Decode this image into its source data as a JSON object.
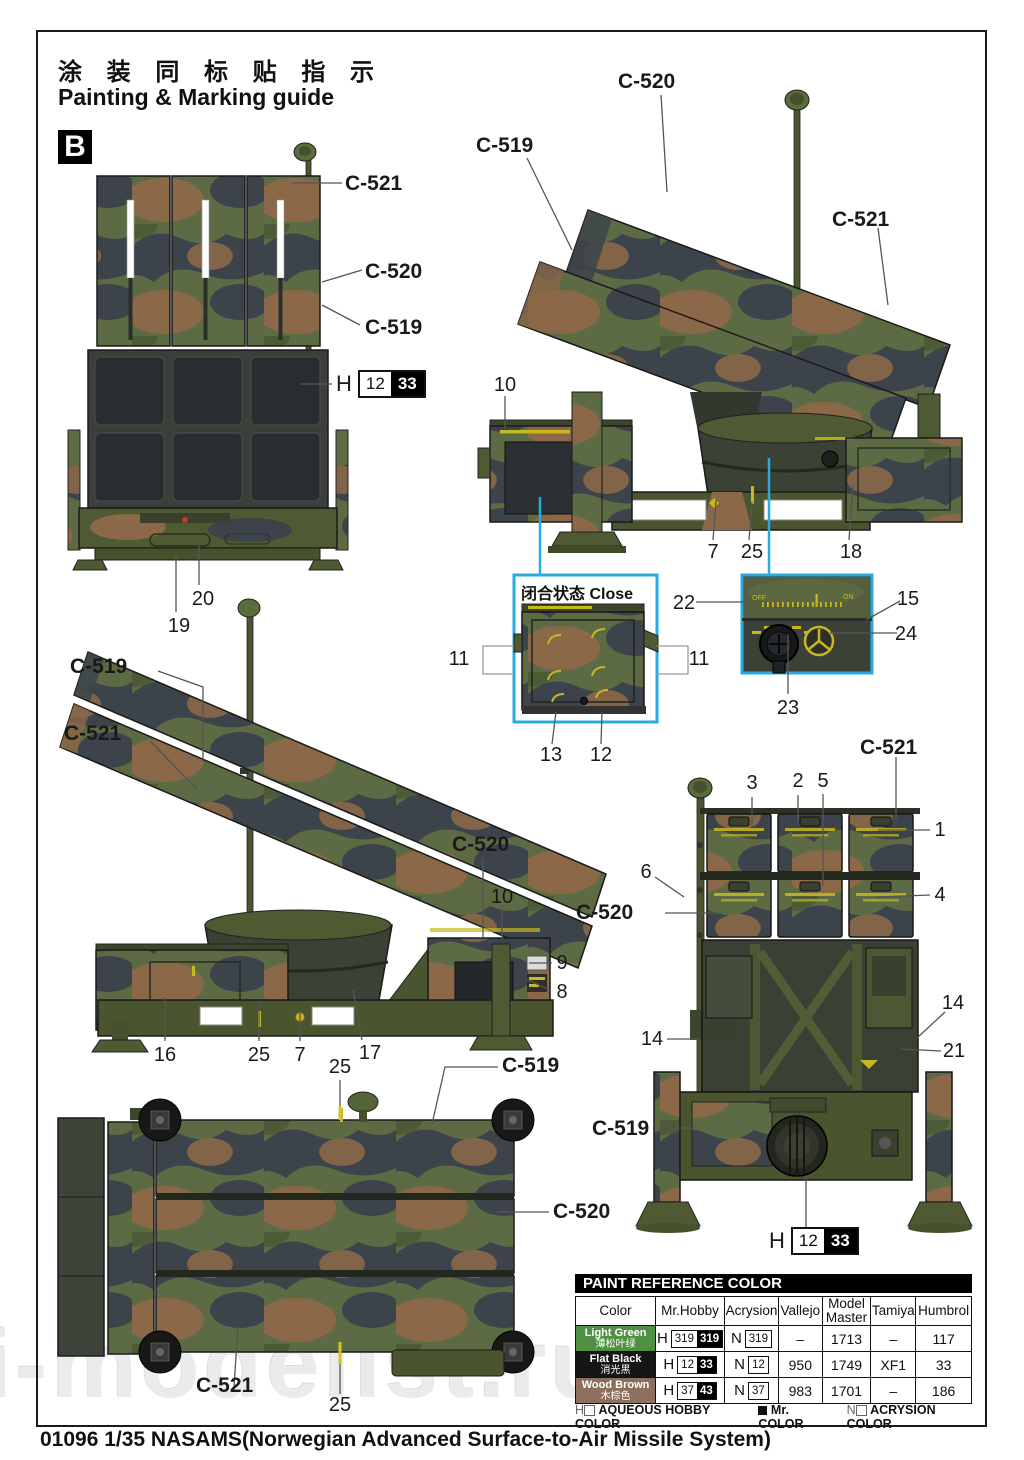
{
  "header": {
    "title_cn": "涂 装 同 标 贴 指 示",
    "title_en": "Painting & Marking guide",
    "section_letter": "B"
  },
  "watermark": "i-modelist.ru",
  "colors": {
    "accent_cyan": "#29abe2",
    "marking_yellow": "#c8b820",
    "camo_green": "#5c6b44",
    "camo_dark": "#3d434a",
    "camo_brown": "#8a6848"
  },
  "h_chip": {
    "prefix": "H",
    "white": "12",
    "black": "33"
  },
  "inset_close": {
    "title": "闭合状态 Close"
  },
  "inset_detail": {
    "off": "OFF",
    "on": "ON"
  },
  "callouts": {
    "c521_a": "C-521",
    "c520_a": "C-520",
    "c519_a": "C-519",
    "n20": "20",
    "n19": "19",
    "c520_b": "C-520",
    "c519_b": "C-519",
    "c521_b": "C-521",
    "n10_a": "10",
    "n7_a": "7",
    "n25_a": "25",
    "n18_a": "18",
    "n11_l": "11",
    "n11_r": "11",
    "n13": "13",
    "n12": "12",
    "n22": "22",
    "n15": "15",
    "n24": "24",
    "n23": "23",
    "c519_c": "C-519",
    "c521_c": "C-521",
    "c520_c": "C-520",
    "n10_b": "10",
    "n9": "9",
    "n8": "8",
    "n16": "16",
    "n25_b": "25",
    "n7_b": "7",
    "n17": "17",
    "n25_c": "25",
    "c519_d": "C-519",
    "c520_d": "C-520",
    "c521_d": "C-521",
    "n25_d": "25",
    "n3": "3",
    "n2": "2",
    "n5": "5",
    "c521_e": "C-521",
    "n1": "1",
    "n6": "6",
    "c520_e": "C-520",
    "n4": "4",
    "n14_l": "14",
    "n14_r": "14",
    "n21": "21",
    "c519_e": "C-519"
  },
  "paint_table": {
    "title": "PAINT  REFERENCE COLOR",
    "columns": [
      "Color",
      "Mr.Hobby",
      "Acrysion",
      "Vallejo",
      "Model Master",
      "Tamiya",
      "Humbrol"
    ],
    "rows": [
      {
        "name_en": "Light Green",
        "name_cn": "薄松叶绿",
        "swatch": "#4f9043",
        "text_color": "#ffffff",
        "mr_prefix": "H",
        "mr_white": "319",
        "mr_black": "319",
        "ac_prefix": "N",
        "ac_white": "319",
        "vallejo": "–",
        "model_master": "1713",
        "tamiya": "–",
        "humbrol": "117"
      },
      {
        "name_en": "Flat Black",
        "name_cn": "消光黑",
        "swatch": "#161616",
        "text_color": "#ffffff",
        "mr_prefix": "H",
        "mr_white": "12",
        "mr_black": "33",
        "ac_prefix": "N",
        "ac_white": "12",
        "vallejo": "950",
        "model_master": "1749",
        "tamiya": "XF1",
        "humbrol": "33"
      },
      {
        "name_en": "Wood Brown",
        "name_cn": "木棕色",
        "swatch": "#8d6f5d",
        "text_color": "#ffffff",
        "mr_prefix": "H",
        "mr_white": "37",
        "mr_black": "43",
        "ac_prefix": "N",
        "ac_white": "37",
        "vallejo": "983",
        "model_master": "1701",
        "tamiya": "–",
        "humbrol": "186"
      }
    ]
  },
  "legend": {
    "h": "H",
    "h_text": "AQUEOUS HOBBY COLOR",
    "mr_text": "Mr. COLOR",
    "n": "N",
    "n_text": "ACRYSION COLOR"
  },
  "footer": "01096 1/35  NASAMS(Norwegian Advanced Surface-to-Air Missile System)"
}
